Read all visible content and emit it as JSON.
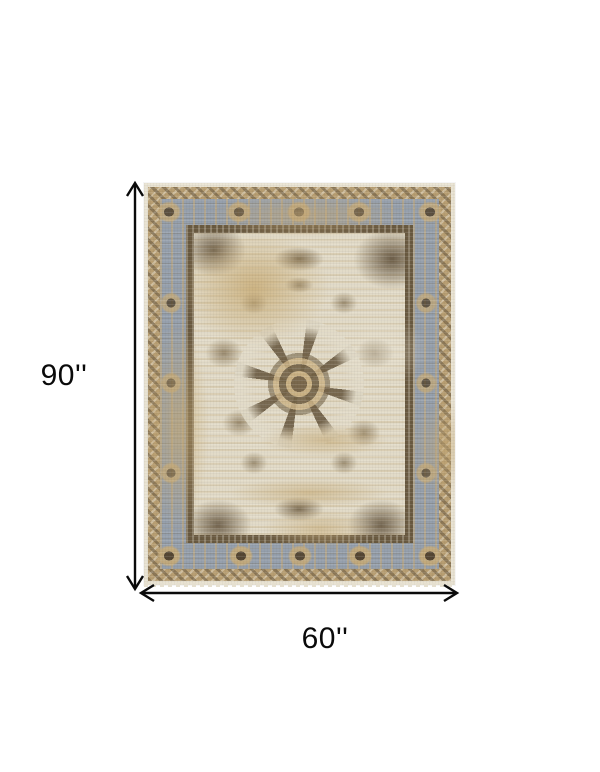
{
  "diagram": {
    "height_label": "90''",
    "width_label": "60''",
    "colors": {
      "background": "#ffffff",
      "arrow": "#0a0a0a",
      "rug_edge_cream": "#e9e3d3",
      "rug_border_tan": "#b89e72",
      "rug_band_blue": "#96a0ad",
      "rug_frame_brown": "#6a5a41",
      "rug_field_cream": "#e2dbc8",
      "rug_accent_brown": "#6b5a44",
      "rug_distress_tan": "#c8ab7a"
    }
  }
}
